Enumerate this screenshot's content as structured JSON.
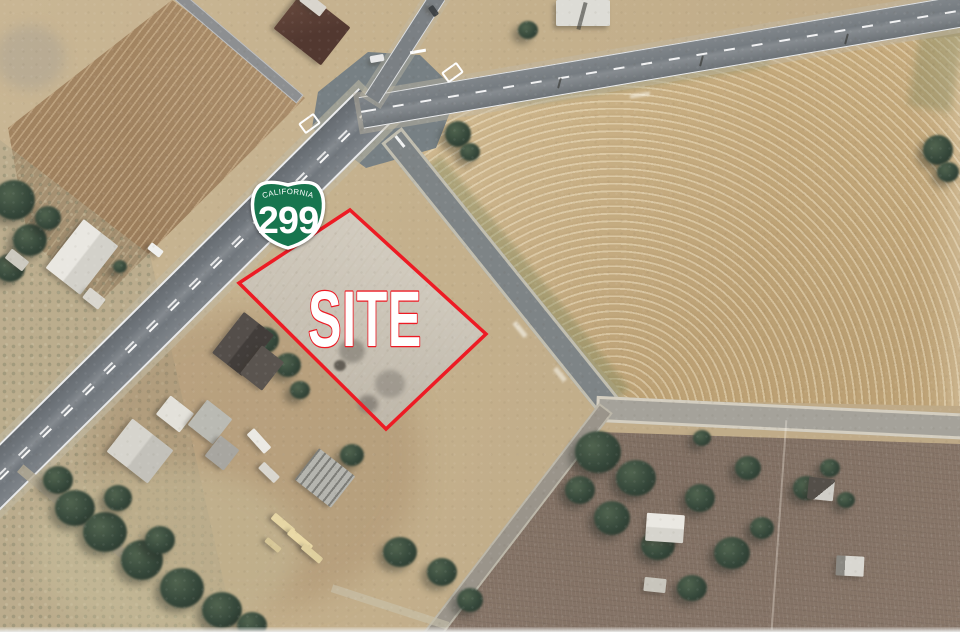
{
  "annotation": {
    "site_label": "SITE",
    "site_label_color": "#ffffff",
    "site_outline_color": "#ed1b24",
    "route_shield": {
      "state_name": "CALIFORNIA",
      "route_number": "299",
      "shield_color": "#17754e",
      "shield_text_color": "#ffffff",
      "shield_border_color": "#ffffff"
    }
  }
}
